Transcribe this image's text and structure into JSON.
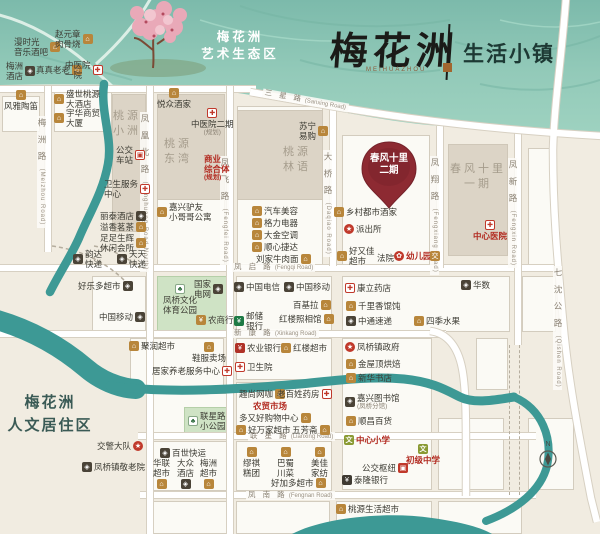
{
  "header": {
    "brand": "梅花洲",
    "brand_en": "MEIHUAZHOU",
    "suffix": "生活小镇"
  },
  "eco_zone": [
    "梅花洲",
    "艺术生态区"
  ],
  "residential": [
    "梅花洲",
    "人文居住区"
  ],
  "pin": {
    "line1": "春风十里",
    "line2": "二期"
  },
  "compass": {
    "n": "N"
  },
  "area_labels": [
    {
      "lines": [
        "桃源",
        "小洲"
      ],
      "xy": [
        113,
        109
      ]
    },
    {
      "lines": [
        "桃源",
        "东湾"
      ],
      "xy": [
        164,
        137
      ]
    },
    {
      "lines": [
        "桃源",
        "林语"
      ],
      "xy": [
        283,
        145
      ]
    },
    {
      "lines": [
        "春风十里",
        "一期"
      ],
      "xy": [
        450,
        162
      ]
    }
  ],
  "road_labels": [
    {
      "zh": "梅 洲 路",
      "en": "(Meizhou Road)",
      "o": "v",
      "xy": [
        37,
        116
      ]
    },
    {
      "zh": "凤 凰 北 路",
      "en": "(Fenghuang Road North)",
      "o": "v",
      "xy": [
        140,
        112
      ]
    },
    {
      "zh": "凤 飞 路",
      "en": "(Fengfei Road)",
      "o": "v",
      "xy": [
        220,
        156
      ]
    },
    {
      "zh": "大 桥 路",
      "en": "(Daqiao Road)",
      "o": "v",
      "xy": [
        323,
        150
      ]
    },
    {
      "zh": "凤 翔 路",
      "en": "(Fengxiang Road)",
      "o": "v",
      "xy": [
        430,
        156
      ]
    },
    {
      "zh": "凤 新 路",
      "en": "(Fengxin Road)",
      "o": "v",
      "xy": [
        508,
        158
      ]
    },
    {
      "zh": "七 沈 公 路",
      "en": "(Qishen Road)",
      "o": "v",
      "xy": [
        553,
        266
      ]
    },
    {
      "zh": "三 星 路",
      "en": "(Sanxing Road)",
      "o": "h",
      "xy": [
        262,
        96
      ],
      "rot": 10
    },
    {
      "zh": "凤 启 路",
      "en": "(Fengqi Road)",
      "o": "h",
      "xy": [
        232,
        263
      ]
    },
    {
      "zh": "新 康 路",
      "en": "(Xinkang Road)",
      "o": "h",
      "xy": [
        232,
        329
      ]
    },
    {
      "zh": "联 星 路",
      "en": "(Lianxing Road)",
      "o": "h",
      "xy": [
        248,
        432
      ]
    },
    {
      "zh": "凤 南 路",
      "en": "(Fengnan Road)",
      "o": "h",
      "xy": [
        246,
        491
      ]
    }
  ],
  "pois": [
    {
      "t": [
        "漫时光",
        "音乐酒吧"
      ],
      "i": "shop",
      "p": "r",
      "xy": [
        14,
        37
      ]
    },
    {
      "t": [
        "赵元章",
        "肉骨烧"
      ],
      "i": "shop",
      "p": "r",
      "xy": [
        55,
        29
      ]
    },
    {
      "t": [
        "梅洲",
        "酒店"
      ],
      "i": "dark",
      "p": "r",
      "xy": [
        6,
        61
      ]
    },
    {
      "t": [
        "真真老老"
      ],
      "i": "shop",
      "p": "r",
      "xy": [
        36,
        65
      ]
    },
    {
      "t": [
        "中医院",
        "一院"
      ],
      "i": "med",
      "p": "r",
      "xy": [
        65,
        60
      ]
    },
    {
      "t": [
        "风雅陶笛"
      ],
      "i": "shop",
      "p": "t",
      "xy": [
        4,
        90
      ]
    },
    {
      "t": [
        "盛世桃源",
        "大酒店"
      ],
      "i": "shop",
      "p": "l",
      "xy": [
        54,
        89
      ]
    },
    {
      "t": [
        "宇华商贸",
        "大厦"
      ],
      "i": "shop",
      "p": "l",
      "xy": [
        54,
        108
      ]
    },
    {
      "t": [
        "悦众酒家"
      ],
      "i": "shop",
      "p": "t",
      "xy": [
        157,
        88
      ]
    },
    {
      "t": [
        "中医院二期",
        "(规划)"
      ],
      "i": "med",
      "p": "t",
      "xy": [
        191,
        108
      ]
    },
    {
      "t": [
        "苏宁",
        "易购"
      ],
      "i": "shop",
      "p": "r",
      "xy": [
        299,
        121
      ]
    },
    {
      "t": [
        "商业",
        "综合体",
        "(规划)"
      ],
      "i": "none",
      "p": "n",
      "xy": [
        204,
        154
      ],
      "c": "red"
    },
    {
      "t": [
        "公交",
        "车站"
      ],
      "i": "bus",
      "p": "r",
      "xy": [
        116,
        145
      ]
    },
    {
      "t": [
        "卫生服务",
        "中心"
      ],
      "i": "med",
      "p": "r",
      "xy": [
        104,
        179
      ]
    },
    {
      "t": [
        "丽泰酒店"
      ],
      "i": "dark",
      "p": "r",
      "xy": [
        100,
        211
      ]
    },
    {
      "t": [
        "溢香茗茶"
      ],
      "i": "shop",
      "p": "r",
      "xy": [
        100,
        222
      ]
    },
    {
      "t": [
        "足足生辉",
        "休闲会所"
      ],
      "i": "shop",
      "p": "r",
      "xy": [
        100,
        233
      ]
    },
    {
      "t": [
        "嘉兴驴友",
        "小哥哥公寓"
      ],
      "i": "shop",
      "p": "l",
      "xy": [
        157,
        202
      ]
    },
    {
      "t": [
        "汽车美容"
      ],
      "i": "shop",
      "p": "l",
      "xy": [
        252,
        206
      ]
    },
    {
      "t": [
        "格力电器"
      ],
      "i": "shop",
      "p": "l",
      "xy": [
        252,
        218
      ]
    },
    {
      "t": [
        "大金空调"
      ],
      "i": "shop",
      "p": "l",
      "xy": [
        252,
        230
      ]
    },
    {
      "t": [
        "顺心捷达"
      ],
      "i": "shop",
      "p": "l",
      "xy": [
        252,
        242
      ]
    },
    {
      "t": [
        "刘家牛肉面"
      ],
      "i": "shop",
      "p": "r",
      "xy": [
        256,
        254
      ]
    },
    {
      "t": [
        "乡村都市酒家"
      ],
      "i": "shop",
      "p": "l",
      "xy": [
        334,
        207
      ]
    },
    {
      "t": [
        "派出所"
      ],
      "i": "gov",
      "p": "l",
      "xy": [
        344,
        224
      ]
    },
    {
      "t": [
        "好又佳",
        "超市"
      ],
      "i": "shop",
      "p": "l",
      "xy": [
        337,
        246
      ]
    },
    {
      "t": [
        "法院"
      ],
      "i": "none",
      "p": "n",
      "xy": [
        377,
        253
      ]
    },
    {
      "t": [
        "幼儿园"
      ],
      "i": "kind",
      "p": "l",
      "xy": [
        394,
        251
      ],
      "c": "red"
    },
    {
      "t": [
        ""
      ],
      "i": "jiao",
      "p": "l",
      "xy": [
        430,
        251
      ]
    },
    {
      "t": [
        "韵达",
        "快递"
      ],
      "i": "dark",
      "p": "l",
      "xy": [
        73,
        249
      ]
    },
    {
      "t": [
        "天天",
        "快递"
      ],
      "i": "dark",
      "p": "l",
      "xy": [
        117,
        249
      ]
    },
    {
      "t": [
        "好乐多超市"
      ],
      "i": "dark",
      "p": "r",
      "xy": [
        78,
        281
      ]
    },
    {
      "t": [
        "中国移动"
      ],
      "i": "dark",
      "p": "r",
      "xy": [
        99,
        312
      ]
    },
    {
      "t": [
        "国家",
        "电网"
      ],
      "i": "dark",
      "p": "r",
      "xy": [
        194,
        279
      ]
    },
    {
      "t": [
        "凤桥文化",
        "体育公园"
      ],
      "i": "tree",
      "p": "t",
      "xy": [
        163,
        284
      ]
    },
    {
      "t": [
        "农商行"
      ],
      "i": "bgold",
      "p": "l",
      "xy": [
        196,
        315
      ]
    },
    {
      "t": [
        "中国电信"
      ],
      "i": "dark",
      "p": "l",
      "xy": [
        234,
        282
      ]
    },
    {
      "t": [
        "中国移动"
      ],
      "i": "dark",
      "p": "l",
      "xy": [
        284,
        282
      ]
    },
    {
      "t": [
        "百基拉"
      ],
      "i": "shop",
      "p": "r",
      "xy": [
        293,
        300
      ]
    },
    {
      "t": [
        "邮储",
        "银行"
      ],
      "i": "bg",
      "p": "l",
      "xy": [
        234,
        311
      ]
    },
    {
      "t": [
        "红楼照相馆"
      ],
      "i": "shop",
      "p": "r",
      "xy": [
        279,
        314
      ]
    },
    {
      "t": [
        "康立药店"
      ],
      "i": "med",
      "p": "l",
      "xy": [
        345,
        283
      ]
    },
    {
      "t": [
        "华数"
      ],
      "i": "dark",
      "p": "l",
      "xy": [
        461,
        280
      ]
    },
    {
      "t": [
        "千里香馄饨"
      ],
      "i": "shop",
      "p": "l",
      "xy": [
        346,
        301
      ]
    },
    {
      "t": [
        "中通速递"
      ],
      "i": "dark",
      "p": "l",
      "xy": [
        346,
        316
      ]
    },
    {
      "t": [
        "四季水果"
      ],
      "i": "shop",
      "p": "l",
      "xy": [
        414,
        316
      ]
    },
    {
      "t": [
        "聚润超市"
      ],
      "i": "shop",
      "p": "l",
      "xy": [
        129,
        341
      ]
    },
    {
      "t": [
        "鞋服卖场"
      ],
      "i": "shop",
      "p": "t",
      "xy": [
        192,
        342
      ]
    },
    {
      "t": [
        "居家养老服务中心"
      ],
      "i": "med",
      "p": "r",
      "xy": [
        152,
        366
      ]
    },
    {
      "t": [
        "农业银行"
      ],
      "i": "br",
      "p": "l",
      "xy": [
        235,
        343
      ]
    },
    {
      "t": [
        "红楼超市"
      ],
      "i": "shop",
      "p": "l",
      "xy": [
        281,
        343
      ]
    },
    {
      "t": [
        "卫生院"
      ],
      "i": "med",
      "p": "l",
      "xy": [
        235,
        362
      ]
    },
    {
      "t": [
        "凤桥镇政府"
      ],
      "i": "gov",
      "p": "l",
      "xy": [
        345,
        342
      ]
    },
    {
      "t": [
        "金屋顶烘焙"
      ],
      "i": "shop",
      "p": "l",
      "xy": [
        346,
        359
      ]
    },
    {
      "t": [
        "新华书店"
      ],
      "i": "shop",
      "p": "l",
      "xy": [
        346,
        373
      ]
    },
    {
      "t": [
        "嘉兴图书馆",
        "(凤桥分馆)"
      ],
      "i": "dark",
      "p": "l",
      "xy": [
        345,
        393
      ]
    },
    {
      "t": [
        "顺昌百货"
      ],
      "i": "shop",
      "p": "l",
      "xy": [
        346,
        416
      ]
    },
    {
      "t": [
        "中心小学"
      ],
      "i": "school",
      "p": "l",
      "xy": [
        344,
        435
      ],
      "c": "red"
    },
    {
      "t": [
        "初级中学"
      ],
      "i": "school",
      "p": "t",
      "xy": [
        406,
        444
      ],
      "c": "red"
    },
    {
      "t": [
        "公交枢纽"
      ],
      "i": "bus2",
      "p": "r",
      "xy": [
        362,
        463
      ]
    },
    {
      "t": [
        "泰隆银行"
      ],
      "i": "bd2",
      "p": "l",
      "xy": [
        342,
        475
      ]
    },
    {
      "t": [
        "联星路",
        "小公园"
      ],
      "i": "tree",
      "p": "l",
      "xy": [
        188,
        411
      ]
    },
    {
      "t": [
        "趣尚网咖"
      ],
      "i": "shop",
      "p": "r",
      "xy": [
        239,
        389
      ]
    },
    {
      "t": [
        "老百姓药房"
      ],
      "i": "med",
      "p": "r",
      "xy": [
        277,
        389
      ]
    },
    {
      "t": [
        "农贸市场"
      ],
      "i": "none",
      "p": "n",
      "xy": [
        253,
        401
      ],
      "c": "red"
    },
    {
      "t": [
        "多又好购物中心"
      ],
      "i": "shop",
      "p": "r",
      "xy": [
        239,
        413
      ]
    },
    {
      "t": [
        "好万家超市"
      ],
      "i": "shop",
      "p": "l",
      "xy": [
        236,
        425
      ]
    },
    {
      "t": [
        "五芳斋"
      ],
      "i": "shop",
      "p": "r",
      "xy": [
        292,
        425
      ]
    },
    {
      "t": [
        "交警大队"
      ],
      "i": "gov",
      "p": "r",
      "xy": [
        97,
        441
      ]
    },
    {
      "t": [
        "凤桥镇敬老院"
      ],
      "i": "dark",
      "p": "l",
      "xy": [
        82,
        462
      ]
    },
    {
      "t": [
        "百世快运"
      ],
      "i": "dark",
      "p": "l",
      "xy": [
        160,
        448
      ]
    },
    {
      "t": [
        "华联",
        "超市"
      ],
      "i": "shop",
      "p": "b",
      "xy": [
        153,
        458
      ]
    },
    {
      "t": [
        "大众",
        "酒店"
      ],
      "i": "dark",
      "p": "b",
      "xy": [
        177,
        458
      ]
    },
    {
      "t": [
        "梅洲",
        "超市"
      ],
      "i": "shop",
      "p": "b",
      "xy": [
        200,
        458
      ]
    },
    {
      "t": [
        "缪祺",
        "糕团"
      ],
      "i": "shop",
      "p": "t",
      "xy": [
        243,
        447
      ]
    },
    {
      "t": [
        "巴蜀",
        "川菜"
      ],
      "i": "shop",
      "p": "t",
      "xy": [
        277,
        447
      ]
    },
    {
      "t": [
        "美佳",
        "家纺"
      ],
      "i": "shop",
      "p": "t",
      "xy": [
        311,
        447
      ]
    },
    {
      "t": [
        "好加多超市"
      ],
      "i": "shop",
      "p": "r",
      "xy": [
        271,
        478
      ]
    },
    {
      "t": [
        "桃源生活超市"
      ],
      "i": "shop",
      "p": "l",
      "xy": [
        336,
        504
      ]
    },
    {
      "t": [
        "中心医院"
      ],
      "i": "med",
      "p": "t",
      "xy": [
        473,
        220
      ],
      "c": "red"
    }
  ]
}
